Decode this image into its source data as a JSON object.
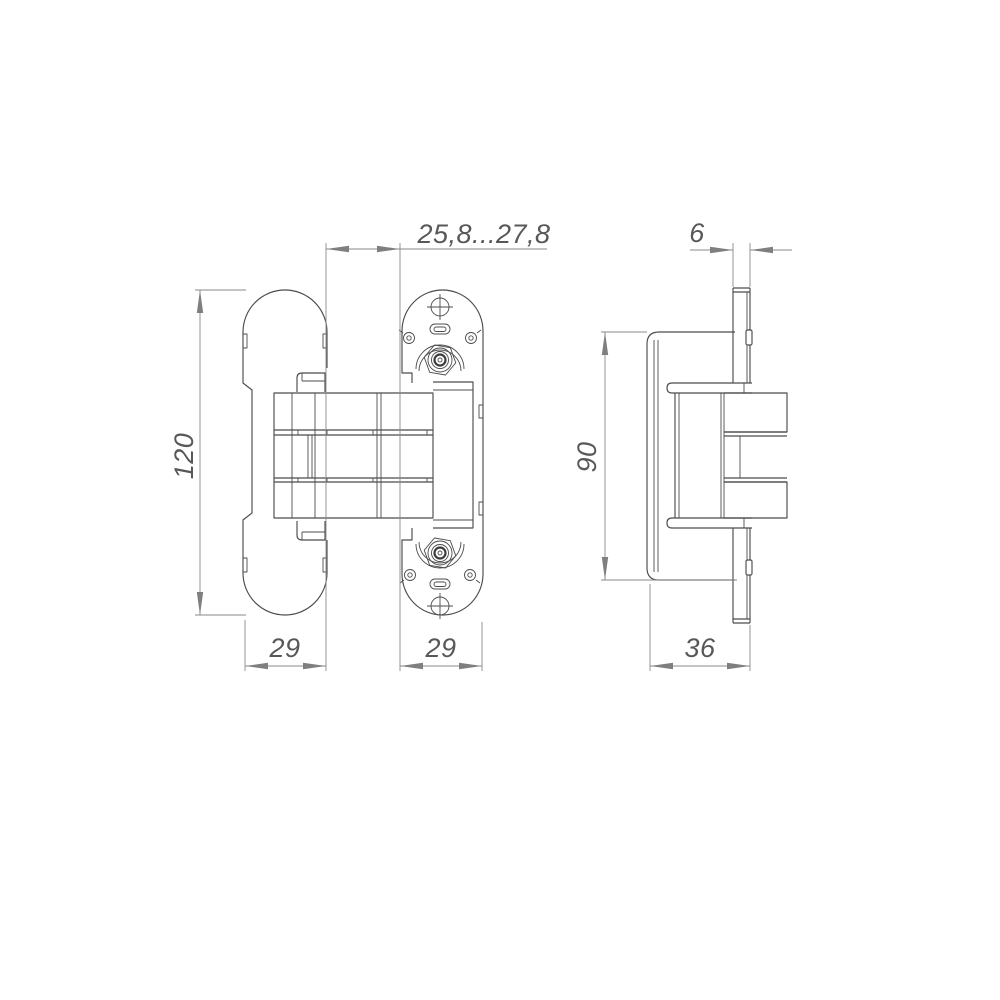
{
  "drawing": {
    "kind": "technical-dimension-drawing",
    "subject": "concealed invisible door hinge, two orthographic views (front and side)",
    "colors": {
      "background": "#ffffff",
      "part_outline": "#4c4c4c",
      "dimension_lines": "#8a8a8a",
      "dimension_text": "#585858"
    },
    "dims": {
      "gap_range": "25,8...27,8",
      "frame_plate_thickness": "6",
      "overall_height": "120",
      "side_body_height": "90",
      "door_leaf_width": "29",
      "frame_leaf_width": "29",
      "side_depth": "36"
    }
  }
}
